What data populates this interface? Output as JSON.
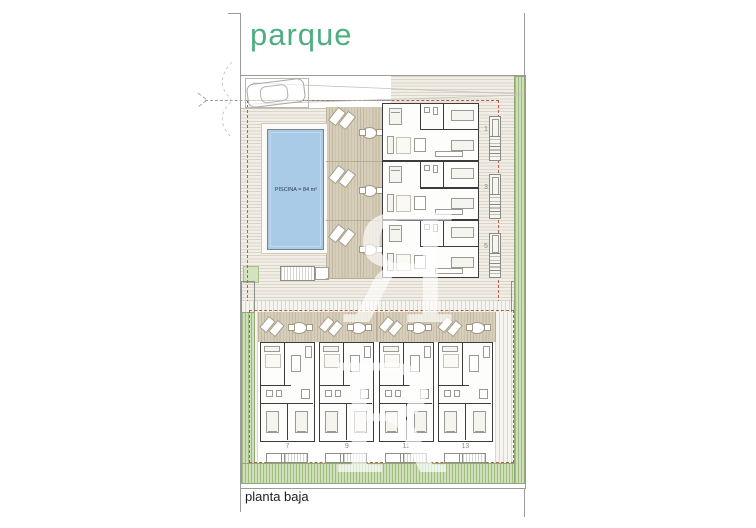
{
  "labels": {
    "park": "parque",
    "floor": "planta baja",
    "pool": "PISCINA = 84 m²"
  },
  "top_units": [
    {
      "number": "1"
    },
    {
      "number": "3"
    },
    {
      "number": "5"
    }
  ],
  "bottom_units": [
    {
      "number": "7"
    },
    {
      "number": "9"
    },
    {
      "number": "11"
    },
    {
      "number": "13"
    }
  ],
  "watermark": {
    "letter": "R"
  },
  "icons": {
    "car": "car-icon",
    "lounger": "lounger-icon",
    "terrace_table": "terrace-table-icon",
    "stairs": "stairs-icon"
  },
  "colors": {
    "park_text": "#4fae80",
    "pool_fill": "#a9cbe8",
    "boundary_dashed": "#b4604a",
    "greenery": "#cfdfba",
    "deck": "#f1eee7",
    "terrace": "#d6cebb",
    "walls": "#3c3c3c",
    "unit_number": "#8b8b83"
  }
}
